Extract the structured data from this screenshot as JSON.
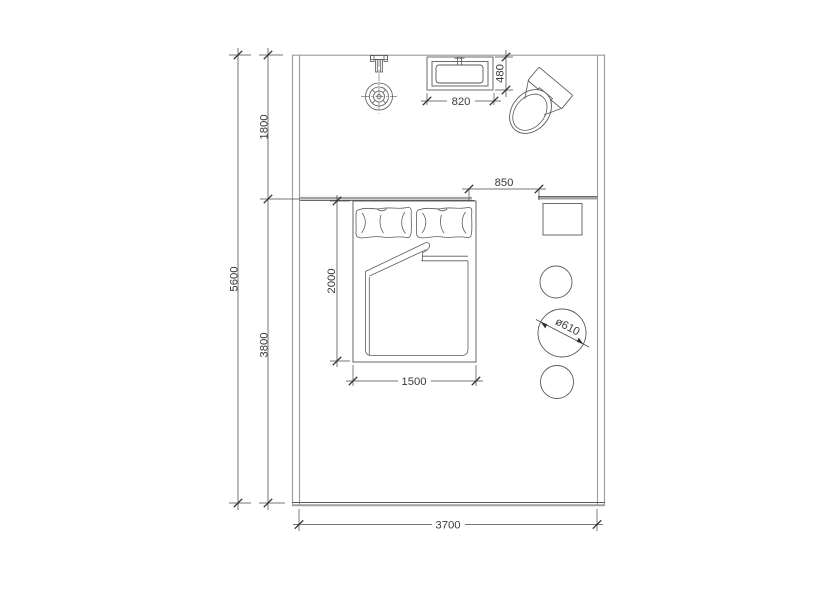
{
  "drawing_title": "bedroom-floor-plan",
  "dimensions": {
    "room_width": "3700",
    "room_depth": "5600",
    "bath_zone_depth": "1800",
    "bed_zone_depth": "3800",
    "opening_width": "850",
    "basin_width": "820",
    "basin_depth": "480",
    "bed_length": "2000",
    "bed_width": "1500",
    "table_diameter": "ø610"
  },
  "colors": {
    "wall": "#9b9b9b",
    "furniture_line": "#5a5a5a",
    "dimension_line": "#474747",
    "text": "#3b3b3b",
    "background": "#ffffff"
  }
}
